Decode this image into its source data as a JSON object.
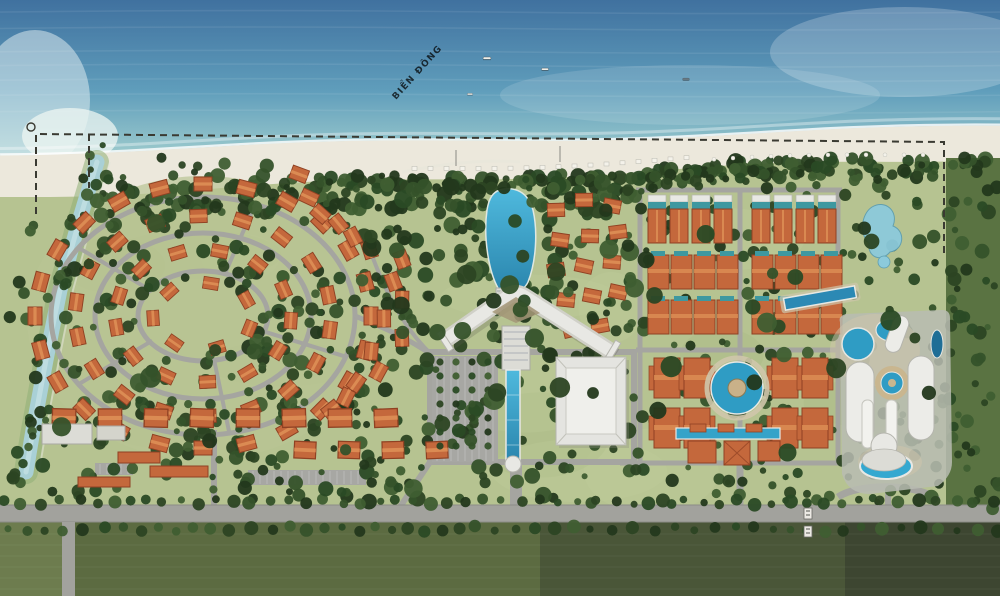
{
  "scene": {
    "description": "aerial-resort-master-plan-rendering",
    "sea_label": "BIỂN ĐÔNG",
    "palette": {
      "sea_deep": "#40719f",
      "sea_mid": "#5f9dbb",
      "sea_shallow": "#9dcbcd",
      "foam": "#e9f2ec",
      "sand": "#ece8dc",
      "land": "#b6c391",
      "lawn_light": "#c6d09e",
      "canopy_dark": "#2c4423",
      "canopy_mid": "#35522a",
      "field_left": "#5c6b41",
      "field_mid": "#4a5638",
      "field_corner": "#3d4631",
      "field_corner_light": "#6d7c4e",
      "roof_orange": "#c4683c",
      "roof_ridge": "#df9257",
      "roof_stroke": "#8f4123",
      "roof_teal": "#3e98a0",
      "road": "#a5a5a0",
      "building_white": "#e8e8e4",
      "building_grey": "#b8bcb2",
      "pool": "#35a3c9",
      "pool_deep": "#2a85ad",
      "pond": "#8ccadb",
      "stream": "#a9d0d6",
      "deck_sand": "#cfc6ab",
      "boundary": "#3a3a32",
      "sea_label_color": "#35566e"
    }
  }
}
